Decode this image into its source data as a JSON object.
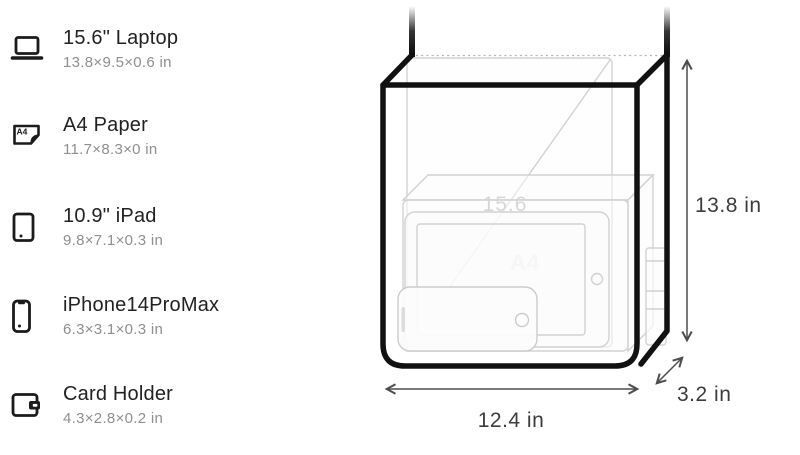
{
  "page": {
    "background": "#ffffff"
  },
  "items": [
    {
      "id": "laptop",
      "name": "15.6\" Laptop",
      "dims": "13.8×9.5×0.6 in"
    },
    {
      "id": "a4-paper",
      "name": "A4 Paper",
      "dims": "11.7×8.3×0 in"
    },
    {
      "id": "ipad",
      "name": "10.9\" iPad",
      "dims": "9.8×7.1×0.3 in"
    },
    {
      "id": "iphone",
      "name": "iPhone14ProMax",
      "dims": "6.3×3.1×0.3 in"
    },
    {
      "id": "card-holder",
      "name": "Card Holder",
      "dims": "4.3×2.8×0.2 in"
    }
  ],
  "icons": {
    "a4_label": "A4"
  },
  "bag": {
    "height_label": "13.8 in",
    "width_label": "12.4 in",
    "depth_label": "3.2 in",
    "watermarks": {
      "laptop": "15.6",
      "a4_sheet": "A4"
    }
  },
  "colors": {
    "frame": "#111111",
    "ghost": "#d2d2d2",
    "dimension_line": "#4d4d4d",
    "dimension_text": "#3c3c3c",
    "title": "#222222",
    "subtitle": "#8f8f8f"
  }
}
